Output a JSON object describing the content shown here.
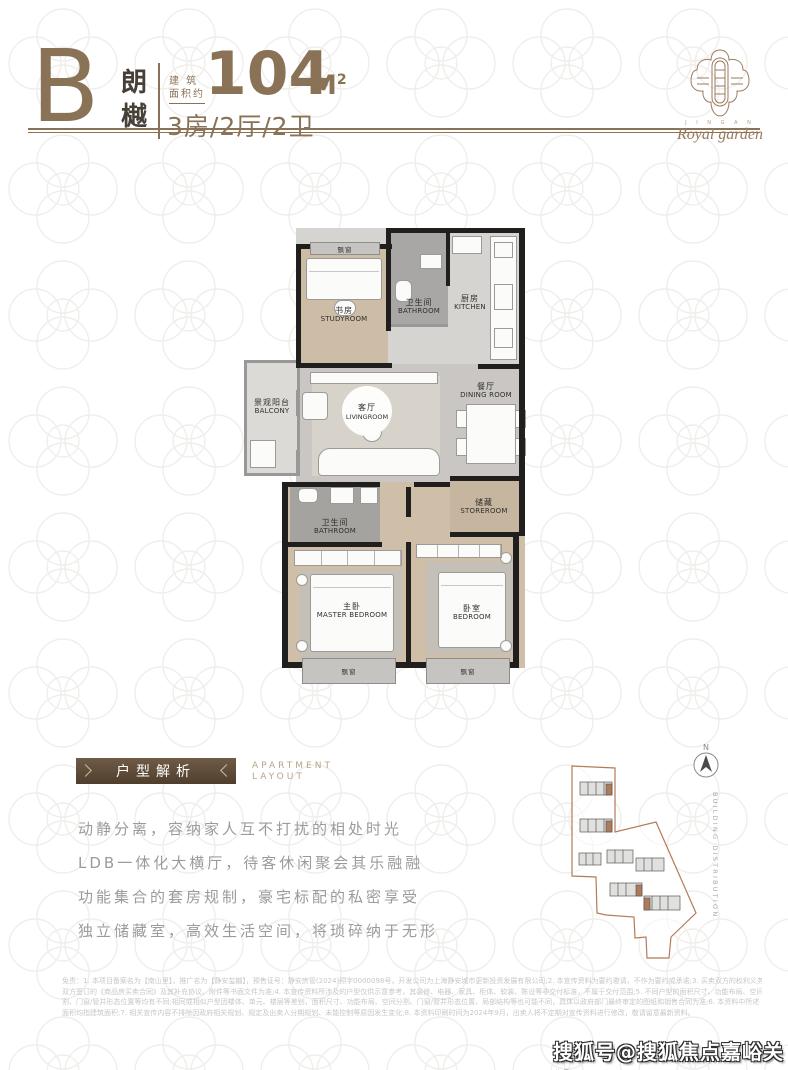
{
  "page": {
    "accent": "#8a7256",
    "wall_color": "#201f1d",
    "watermark": "搜狐号@搜狐焦点嘉峪关站"
  },
  "header": {
    "unit_letter": "B",
    "unit_name": "朗樾",
    "area_label_line1": "建 筑",
    "area_label_line2": "面积约",
    "area_value": "104",
    "area_unit_main": "M",
    "area_unit_sup": "2",
    "room_config": "3房/2厅/2卫"
  },
  "logo": {
    "brand_small": "J I N G A N",
    "brand_script": "Royal garden"
  },
  "floorplan": {
    "bay_window": "飘窗",
    "rooms": [
      {
        "zh": "书房",
        "en": "STUDYROOM"
      },
      {
        "zh": "卫生间",
        "en": "BATHROOM"
      },
      {
        "zh": "厨房",
        "en": "KITCHEN"
      },
      {
        "zh": "景观阳台",
        "en": "BALCONY"
      },
      {
        "zh": "客厅",
        "en": "LIVINGROOM"
      },
      {
        "zh": "餐厅",
        "en": "DINING ROOM"
      },
      {
        "zh": "储藏",
        "en": "STOREROOM"
      },
      {
        "zh": "卫生间",
        "en": "BATHROOM"
      },
      {
        "zh": "主卧",
        "en": "MASTER BEDROOM"
      },
      {
        "zh": "卧室",
        "en": "BEDROOM"
      }
    ]
  },
  "analysis": {
    "ribbon_title": "户型解析",
    "subtitle_line1": "APARTMENT",
    "subtitle_line2": "LAYOUT",
    "lines": [
      "动静分离，容纳家人互不打扰的相处时光",
      "LDB一体化大横厅，待客休闲聚会其乐融融",
      "功能集合的套房规制，豪宅标配的私密享受",
      "独立储藏室，高效生活空间，将琐碎纳于无形"
    ]
  },
  "siteplan": {
    "north": "N",
    "caption": "BUILDING DISTRIBUTION"
  },
  "disclaimer": {
    "lines": [
      "免责：1. 本项目备案名为【南山里】，推广名为【静安玺樾】，预售证号：静安房管(2024)预字0000098号，开发公司为上海静安城市更新投资发展有限公司;2. 本宣传资料为要约邀请，不作为要约或承诺;3. 买卖双方的权利义务以",
      "双方签订的《商品房买卖合同》及其补充协议、附件等书面文件为准;4. 本宣传资料所涉及的户型仅供示意参考，其装修、电器、家具、柜体、软装、陈设等非交付标准，不属于交付范围;5. 不同户型的面积尺寸、功能布局、空间分",
      "割、门窗/管井形态位置等均有不同;相同或相似户型因楼体、单元、楼层等差别，面积尺寸、功能布局、空间分割、门窗/管井形态位置、局部结构等也可能不同，具体以政府部门最终审定的图纸和销售合同为准;6. 本资料中所述",
      "面积均指建筑面积;7. 相关宣传内容不排除因政府相关规划、规定及出卖人分期规划、未能控制等原因发生变化;8. 本资料印刷时间为2024年9月，出卖人将不定期对宣传资料进行修改，敬请留意最新资料。"
    ]
  }
}
